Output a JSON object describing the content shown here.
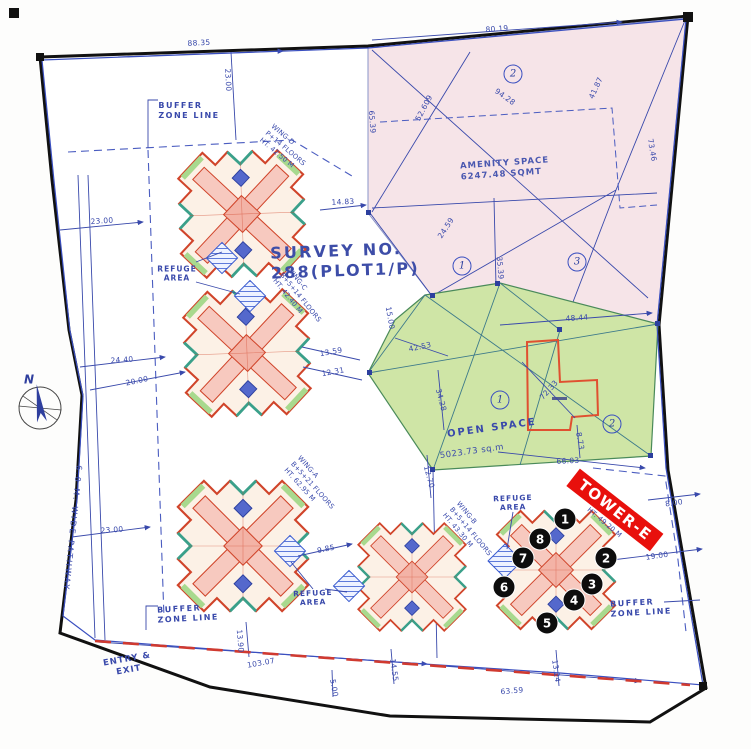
{
  "survey_title": "SURVEY NO.\n288(PLOT1/P)",
  "amenity_label": "AMENITY SPACE\n6247.48 SQMT",
  "open_space_name": "OPEN SPACE",
  "open_space_area": "5023.73 sq.m",
  "tower_banner": "TOWER-E",
  "north": "N",
  "entry_exit": "ENTRY &\nEXIT",
  "pathway": "6.0 M. WIDE PATHWAY",
  "colors": {
    "plan_blue": "#3949ab",
    "building_red": "#d0442a",
    "amenity_pink": "#f6e4e8",
    "open_space_green": "#cfe5a6",
    "banner_red": "#e8100c",
    "marker_black": "#0d0d0d",
    "boundary_black": "#111111",
    "red_dash": "#d03a30",
    "teal_accent": "#3aa08a"
  },
  "wing_labels": [
    {
      "t": "WING-D\nP+14 FLOORS\nHT. 42.50 M",
      "x": 285,
      "y": 149,
      "r": 40
    },
    {
      "t": "WING-C\nB+5+14 FLOORS\nHT. 42.40 M",
      "x": 300,
      "y": 298,
      "r": 51
    },
    {
      "t": "WING-A\nB+5+21 FLOORS\nHT. 62.95 M",
      "x": 312,
      "y": 486,
      "r": 48
    },
    {
      "t": "WING-B\nB+5+14 FLOORS\nHT. 43.30 M",
      "x": 470,
      "y": 532,
      "r": 50
    },
    {
      "t": "HT. 49.20 M",
      "x": 604,
      "y": 523,
      "r": 40
    }
  ],
  "buffer_labels": [
    {
      "t": "BUFFER\nZONE LINE",
      "x": 189,
      "y": 111,
      "r": 0
    },
    {
      "t": "BUFFER\nZONE LINE",
      "x": 188,
      "y": 614,
      "r": -3
    },
    {
      "t": "BUFFER\nZONE LINE",
      "x": 641,
      "y": 608,
      "r": -3
    }
  ],
  "refuge_labels": [
    {
      "t": "REFUGE\nAREA",
      "x": 177,
      "y": 274,
      "r": 0
    },
    {
      "t": "REFUGE\nAREA",
      "x": 513,
      "y": 503,
      "r": -2
    },
    {
      "t": "REFUGE\nAREA",
      "x": 313,
      "y": 598,
      "r": -2
    }
  ],
  "region_numbers": [
    {
      "t": "2",
      "x": 513,
      "y": 74
    },
    {
      "t": "1",
      "x": 462,
      "y": 266
    },
    {
      "t": "3",
      "x": 577,
      "y": 262
    },
    {
      "t": "1",
      "x": 500,
      "y": 400
    },
    {
      "t": "2",
      "x": 612,
      "y": 424
    }
  ],
  "unit_markers": [
    {
      "n": "1",
      "x": 565,
      "y": 519
    },
    {
      "n": "2",
      "x": 606,
      "y": 558
    },
    {
      "n": "3",
      "x": 592,
      "y": 584
    },
    {
      "n": "4",
      "x": 574,
      "y": 600
    },
    {
      "n": "5",
      "x": 547,
      "y": 623
    },
    {
      "n": "6",
      "x": 504,
      "y": 587
    },
    {
      "n": "7",
      "x": 523,
      "y": 558
    },
    {
      "n": "8",
      "x": 540,
      "y": 539
    }
  ],
  "dimensions": [
    {
      "t": "88.35",
      "x": 199,
      "y": 43,
      "r": -3
    },
    {
      "t": "23.00",
      "x": 228,
      "y": 80,
      "r": 87
    },
    {
      "t": "80.19",
      "x": 497,
      "y": 29,
      "r": -4
    },
    {
      "t": "94.28",
      "x": 505,
      "y": 97,
      "r": 35
    },
    {
      "t": "41.87",
      "x": 596,
      "y": 88,
      "r": -65
    },
    {
      "t": "52.609",
      "x": 424,
      "y": 108,
      "r": -62
    },
    {
      "t": "65.39",
      "x": 372,
      "y": 122,
      "r": 85
    },
    {
      "t": "73.46",
      "x": 652,
      "y": 150,
      "r": 80
    },
    {
      "t": "14.83",
      "x": 343,
      "y": 202,
      "r": -3
    },
    {
      "t": "24.59",
      "x": 446,
      "y": 228,
      "r": -57
    },
    {
      "t": "35.39",
      "x": 500,
      "y": 268,
      "r": 85
    },
    {
      "t": "48.44",
      "x": 577,
      "y": 318,
      "r": -4
    },
    {
      "t": "15.00",
      "x": 390,
      "y": 318,
      "r": 80
    },
    {
      "t": "42.53",
      "x": 420,
      "y": 347,
      "r": -12
    },
    {
      "t": "34.28",
      "x": 441,
      "y": 400,
      "r": 75
    },
    {
      "t": "13.59",
      "x": 331,
      "y": 352,
      "r": -10
    },
    {
      "t": "12.31",
      "x": 333,
      "y": 372,
      "r": -10
    },
    {
      "t": "72.33",
      "x": 549,
      "y": 390,
      "r": -48
    },
    {
      "t": "12.70",
      "x": 429,
      "y": 477,
      "r": 75
    },
    {
      "t": "66.03",
      "x": 568,
      "y": 461,
      "r": -3
    },
    {
      "t": "8.73",
      "x": 580,
      "y": 441,
      "r": 80
    },
    {
      "t": "8.00",
      "x": 674,
      "y": 503,
      "r": -8
    },
    {
      "t": "19.00",
      "x": 657,
      "y": 556,
      "r": -8
    },
    {
      "t": "23.00",
      "x": 102,
      "y": 221,
      "r": -4
    },
    {
      "t": "24.40",
      "x": 122,
      "y": 360,
      "r": -4
    },
    {
      "t": "20.00",
      "x": 137,
      "y": 381,
      "r": -12
    },
    {
      "t": "23.00",
      "x": 112,
      "y": 530,
      "r": -4
    },
    {
      "t": "9.85",
      "x": 326,
      "y": 549,
      "r": -12
    },
    {
      "t": "103.07",
      "x": 261,
      "y": 663,
      "r": -10
    },
    {
      "t": "13.90",
      "x": 240,
      "y": 641,
      "r": 85
    },
    {
      "t": "5.00",
      "x": 334,
      "y": 688,
      "r": 80
    },
    {
      "t": "14.55",
      "x": 394,
      "y": 670,
      "r": 82
    },
    {
      "t": "63.59",
      "x": 512,
      "y": 691,
      "r": -5
    },
    {
      "t": "13.24",
      "x": 556,
      "y": 671,
      "r": 82
    }
  ]
}
